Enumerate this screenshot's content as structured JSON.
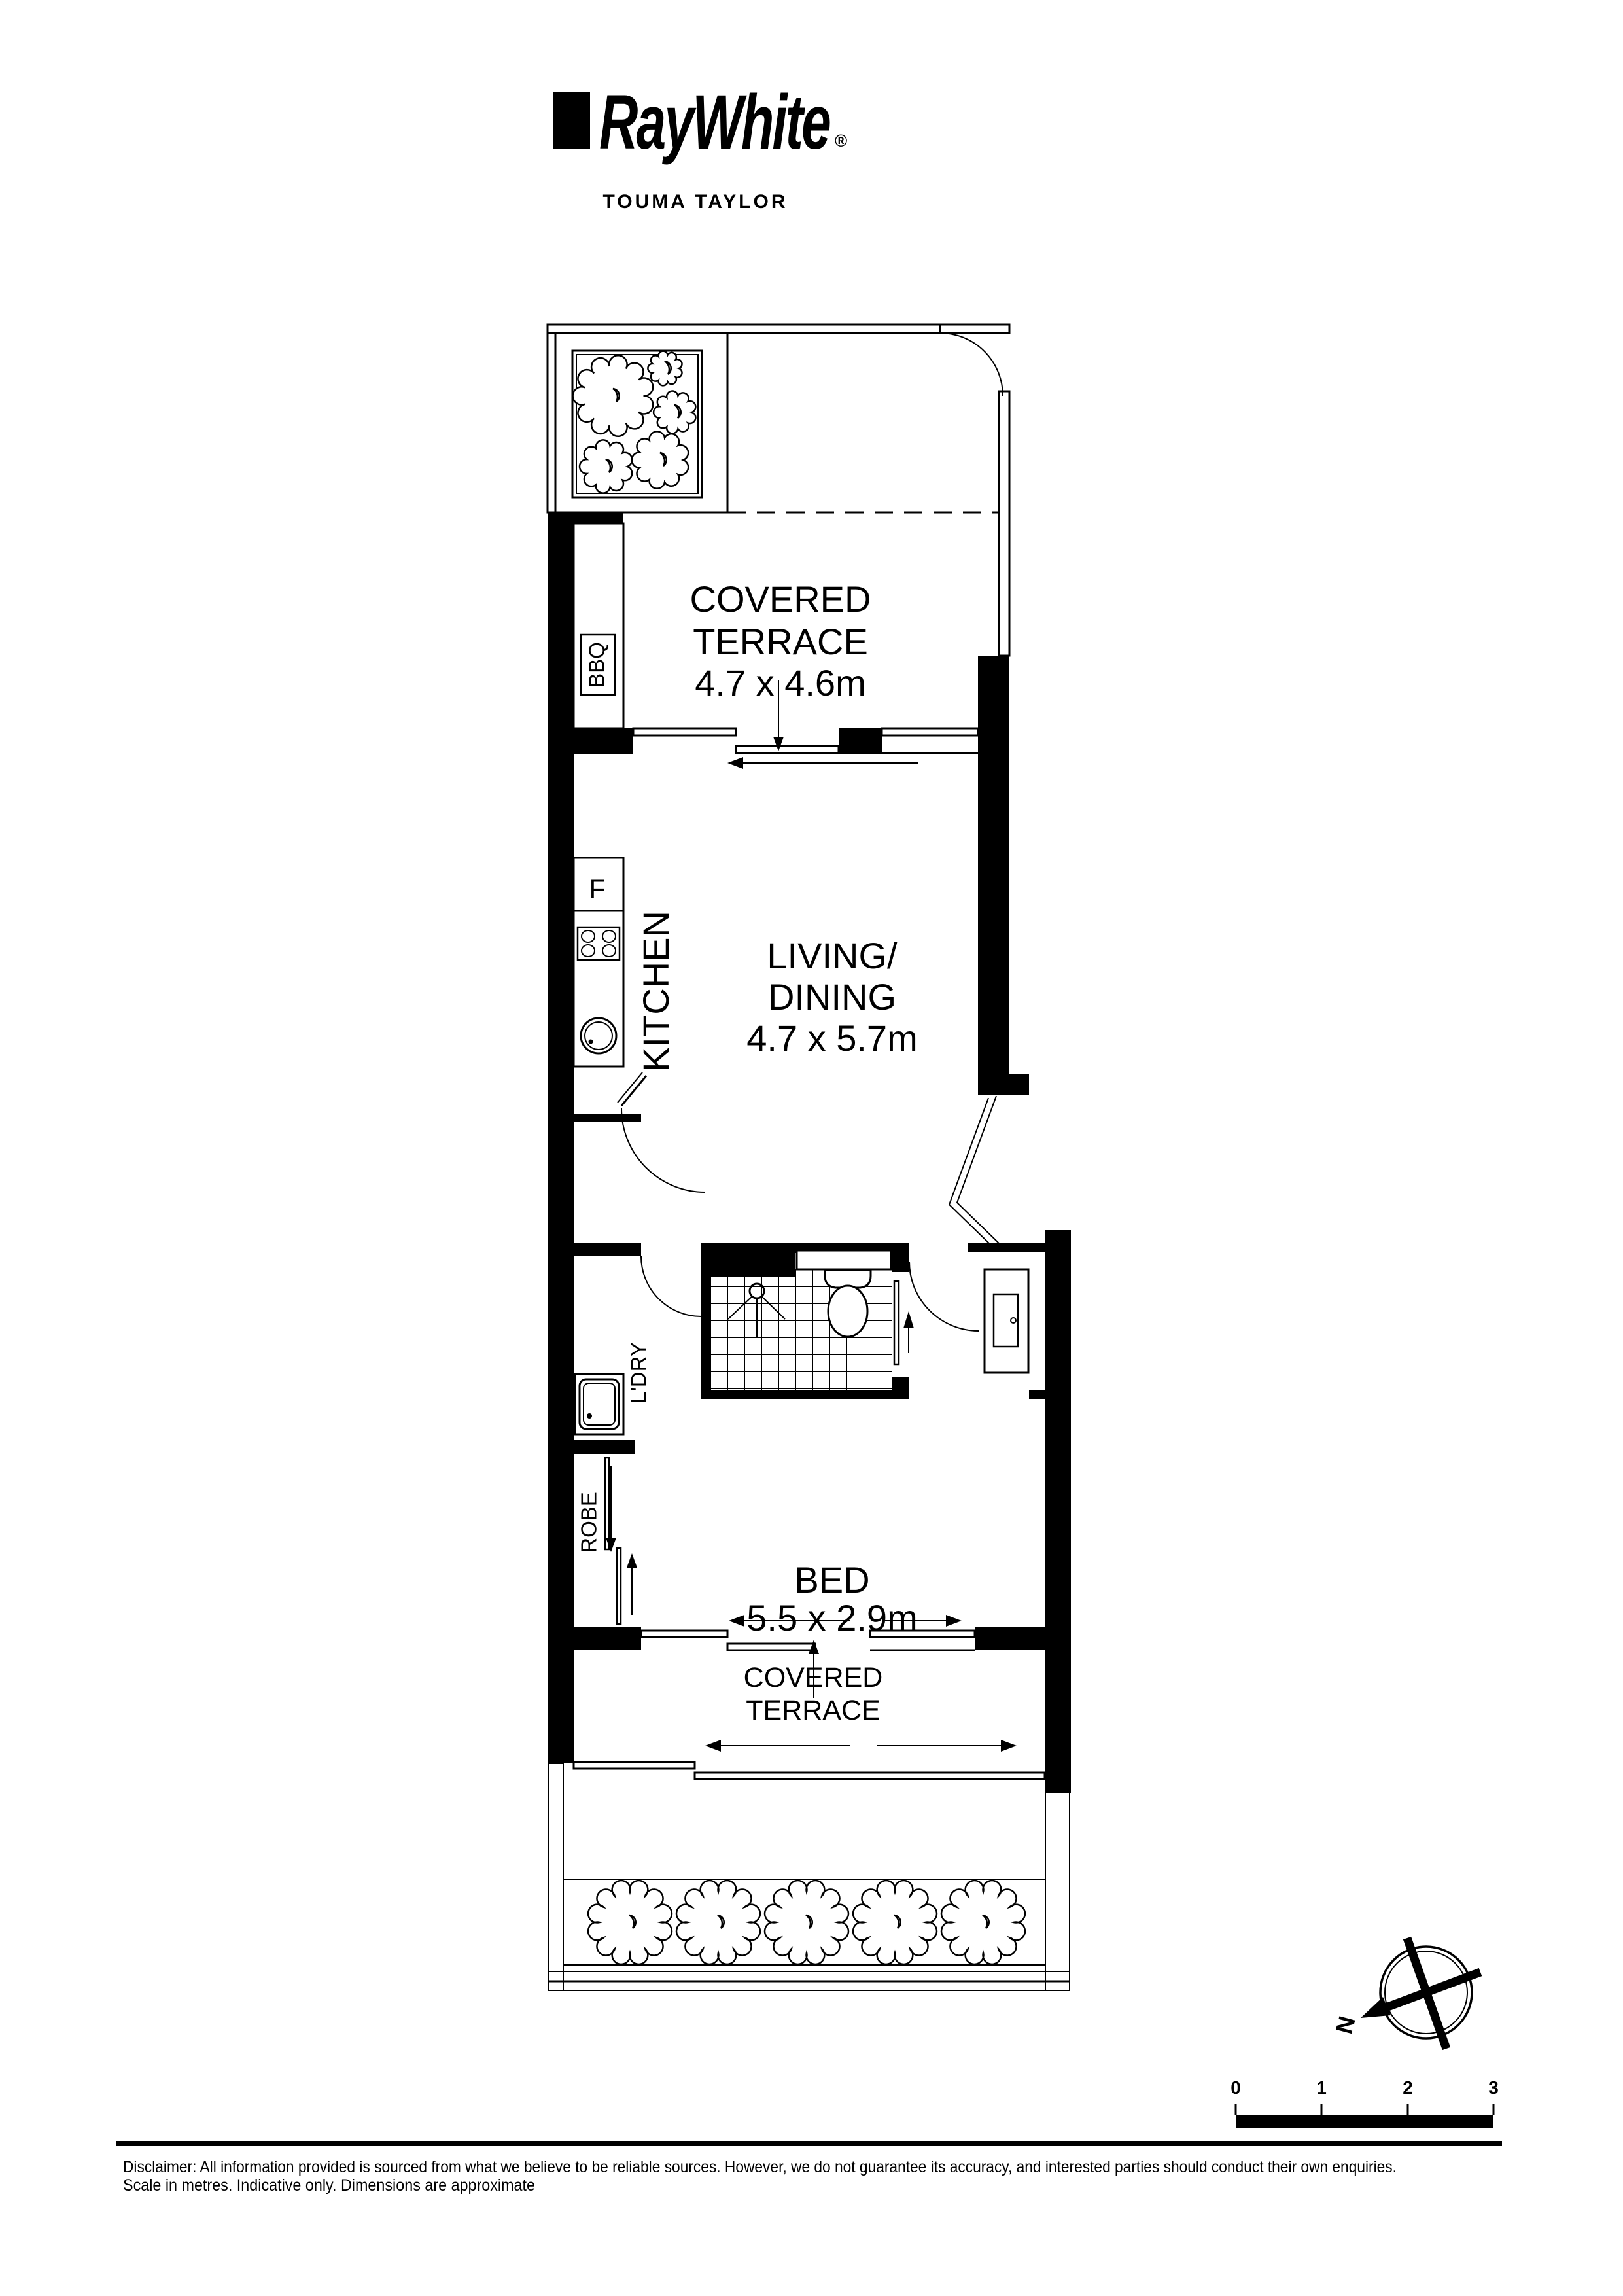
{
  "header": {
    "brand": "RayWhite",
    "registered": "®",
    "office": "TOUMA TAYLOR"
  },
  "plan": {
    "terrace_top": {
      "line1": "COVERED",
      "line2": "TERRACE",
      "dims": "4.7 x 4.6m"
    },
    "bbq": "BBQ",
    "kitchen": {
      "label": "KITCHEN",
      "fridge": "F"
    },
    "living": {
      "line1": "LIVING/",
      "line2": "DINING",
      "dims": "4.7 x 5.7m"
    },
    "laundry": "L'DRY",
    "robe": "ROBE",
    "bed": {
      "label": "BED",
      "dims": "5.5 x 2.9m"
    },
    "terrace_bottom": {
      "line1": "COVERED",
      "line2": "TERRACE"
    }
  },
  "compass": {
    "north_label": "N"
  },
  "scale_bar": {
    "tick_labels": [
      "0",
      "1",
      "2",
      "3"
    ]
  },
  "footer": {
    "disclaimer_line1": "Disclaimer: All information provided is sourced from what we believe to be reliable sources. However, we do not guarantee  its accuracy, and interested parties should conduct their own enquiries.",
    "disclaimer_line2": "Scale in metres. Indicative only. Dimensions are approximate"
  },
  "colors": {
    "ink": "#000000",
    "paper": "#ffffff"
  }
}
